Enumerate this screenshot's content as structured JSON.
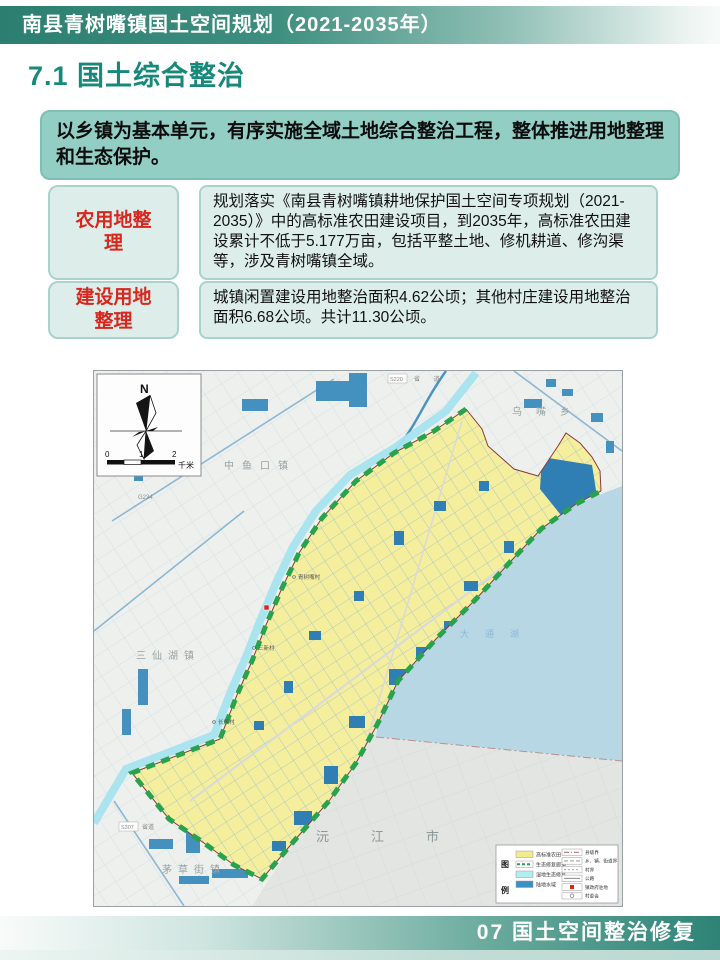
{
  "header": {
    "title": "南县青树嘴镇国土空间规划（2021-2035年）"
  },
  "section": {
    "title": "7.1 国土综合整治"
  },
  "intro": {
    "text": "以乡镇为基本单元，有序实施全域土地综合整治工程，整体推进用地整理和生态保护。"
  },
  "items": [
    {
      "label": "农用地整理",
      "text": "规划落实《南县青树嘴镇耕地保护国土空间专项规划（2021-2035）》中的高标准农田建设项目，到2035年，高标准农田建设累计不低于5.177万亩，包括平整土地、修机耕道、修沟渠等，涉及青树嘴镇全域。"
    },
    {
      "label": "建设用地整理",
      "text": "城镇闲置建设用地整治面积4.62公顷；其他村庄建设用地整治面积6.68公顷。共计11.30公顷。"
    }
  ],
  "map": {
    "compass": {
      "north": "N",
      "scale_0": "0",
      "scale_1": "1",
      "scale_2": "2",
      "scale_unit": "千米"
    },
    "towns": {
      "zhongyukou": "中鱼口镇",
      "wuzui": "乌嘴乡",
      "sanxianhu": "三仙湖镇",
      "maocaojie": "茅草街镇"
    },
    "city": "沅江市",
    "lake": "大通湖",
    "villages": {
      "qingshuzui": "青树嘴村",
      "sanxin": "三新村",
      "changkang": "长康村"
    },
    "roads": {
      "g234": "G234",
      "s220": "S220",
      "s220_type": "省 道",
      "s307": "S307",
      "s307_type": "省道"
    },
    "legend": {
      "title_top": "图",
      "title_bottom": "例",
      "area_items": [
        {
          "label": "高标准农田",
          "color": "#f2ea8e"
        },
        {
          "label": "生态修复廊道",
          "color": "#28a24c"
        },
        {
          "label": "湿地生态修复",
          "color": "#b2edf2"
        },
        {
          "label": "陆地水域",
          "color": "#3c8fc2"
        }
      ],
      "line_items": [
        {
          "label": "县级界"
        },
        {
          "label": "乡、镇、街道界"
        },
        {
          "label": "村界"
        },
        {
          "label": "公路"
        },
        {
          "label": "镇政府驻地"
        },
        {
          "label": "村委会"
        }
      ]
    }
  },
  "footer": {
    "text": "07 国土空间整治修复"
  },
  "colors": {
    "header_teal": "#2e8173",
    "section_teal": "#17897a",
    "intro_bg": "#92cec4",
    "panel_bg": "#ddeeea",
    "panel_border": "#a9d2ca",
    "label_red": "#d8271d",
    "footer_teal": "#2d8376",
    "farmland_yellow": "#f5ee9d",
    "corridor_green": "#28a24c",
    "water_blue": "#4490bf",
    "lake_blue": "#b7d7e5"
  }
}
